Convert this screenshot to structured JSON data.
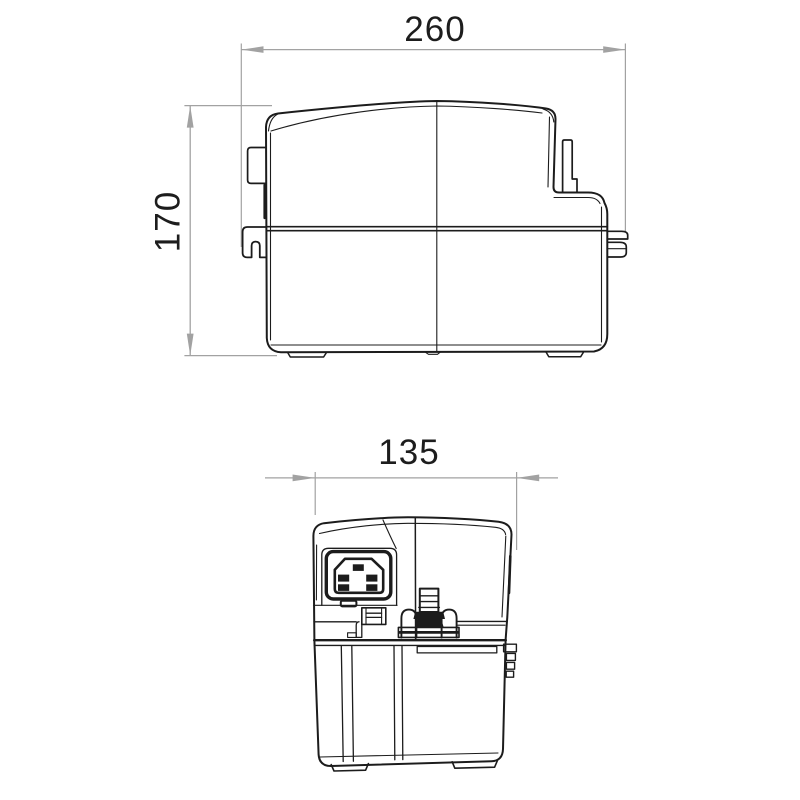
{
  "drawing": {
    "kind": "dimensional-technical-drawing",
    "subject": "condensate-pump-two-view-outline",
    "dimensions": {
      "width_label": "260",
      "height_label": "170",
      "depth_label": "135"
    },
    "views": {
      "front": {
        "name": "front-view",
        "width_ref": "260",
        "height_ref": "170"
      },
      "side": {
        "name": "side-view",
        "width_ref": "135"
      }
    },
    "colors": {
      "line": "#1c1c1c",
      "dimension_line": "#a2a2a2",
      "label_text": "#1d1d1d",
      "background": "#ffffff"
    }
  }
}
